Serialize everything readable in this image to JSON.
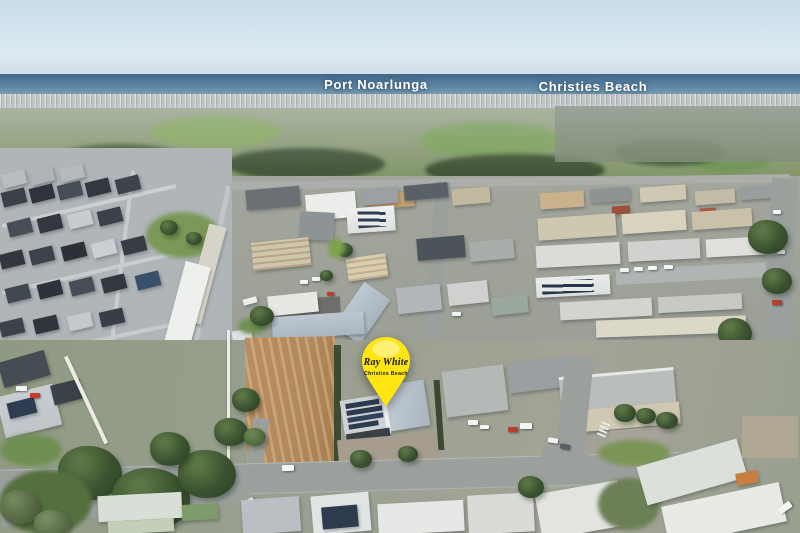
{
  "scene": {
    "type": "aerial-photograph",
    "description": "Drone aerial photo over an industrial estate and new housing, looking toward the coastline and sea",
    "width_px": 800,
    "height_px": 533
  },
  "labels": {
    "port_noarlunga": "Port Noarlunga",
    "christies_beach": "Christies Beach"
  },
  "pin": {
    "brand": "Ray White",
    "office": "Christies Beach"
  },
  "colors": {
    "pin_yellow": "#FFE512",
    "pin_text": "#141414",
    "label_text": "#FFFFFF",
    "sky_top": "#C9DCE9",
    "sky_bottom": "#DDEAF2",
    "ocean_deep": "#41678B",
    "ocean_shore": "#7EA2B6",
    "vegetation": "#3E5634",
    "dirt": "#B1875C",
    "road": "#9BA09D"
  }
}
